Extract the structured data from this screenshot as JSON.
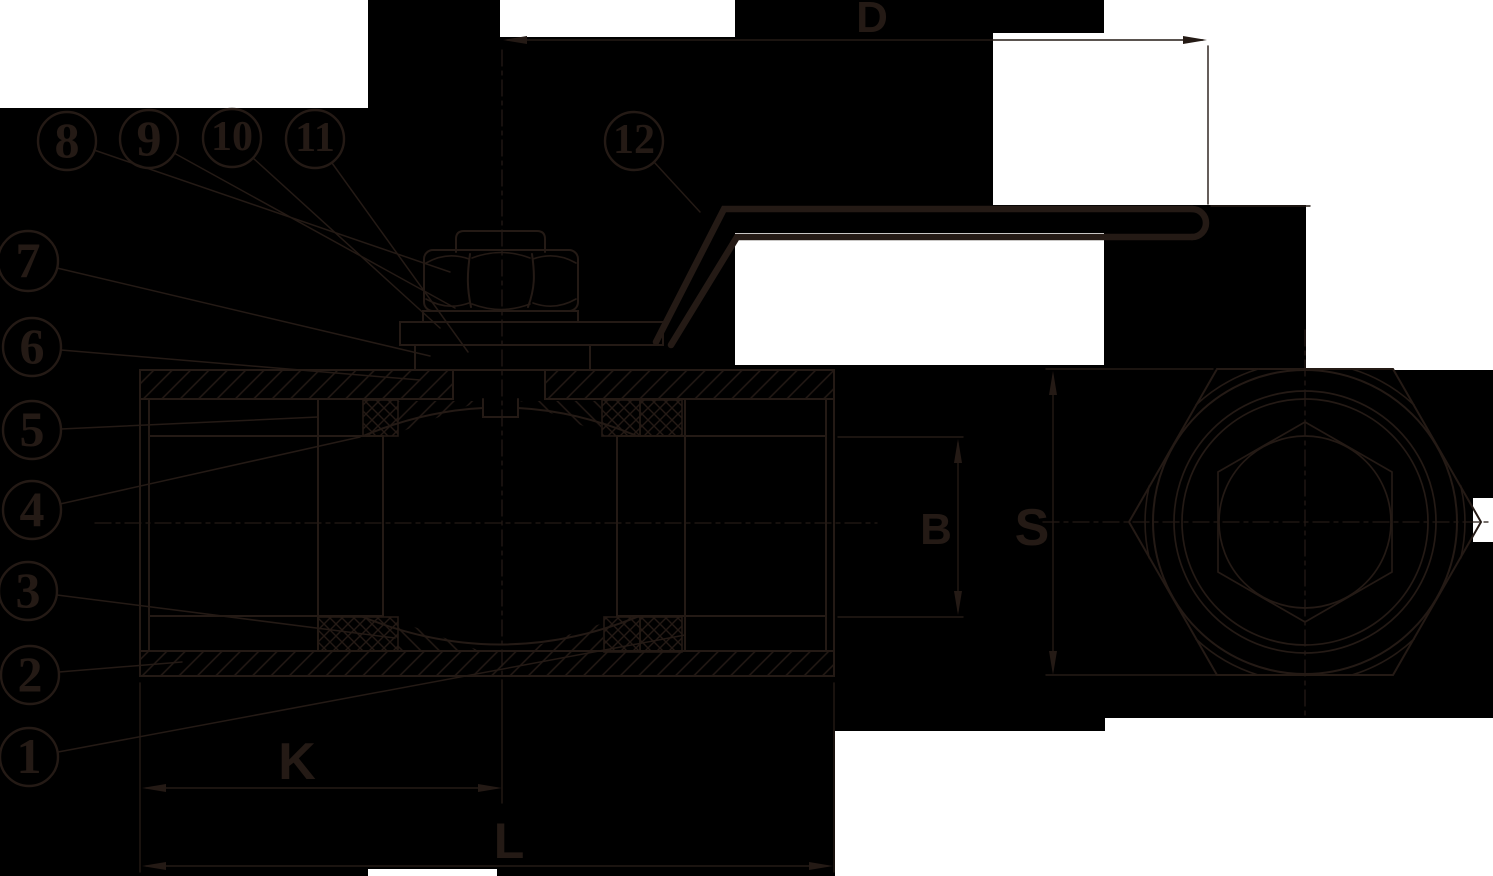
{
  "drawing": {
    "title": "ball-valve-cross-section-technical-drawing",
    "views": [
      "side-section-view",
      "end-hex-view"
    ],
    "colors": {
      "background": "#000000",
      "paper_patch": "#ffffff",
      "ink": "#241a15"
    },
    "labels": {
      "D": "D",
      "B": "B",
      "S": "S",
      "K": "K",
      "L": "L"
    },
    "callouts": [
      "1",
      "2",
      "3",
      "4",
      "5",
      "6",
      "7",
      "8",
      "9",
      "10",
      "11",
      "12"
    ]
  }
}
